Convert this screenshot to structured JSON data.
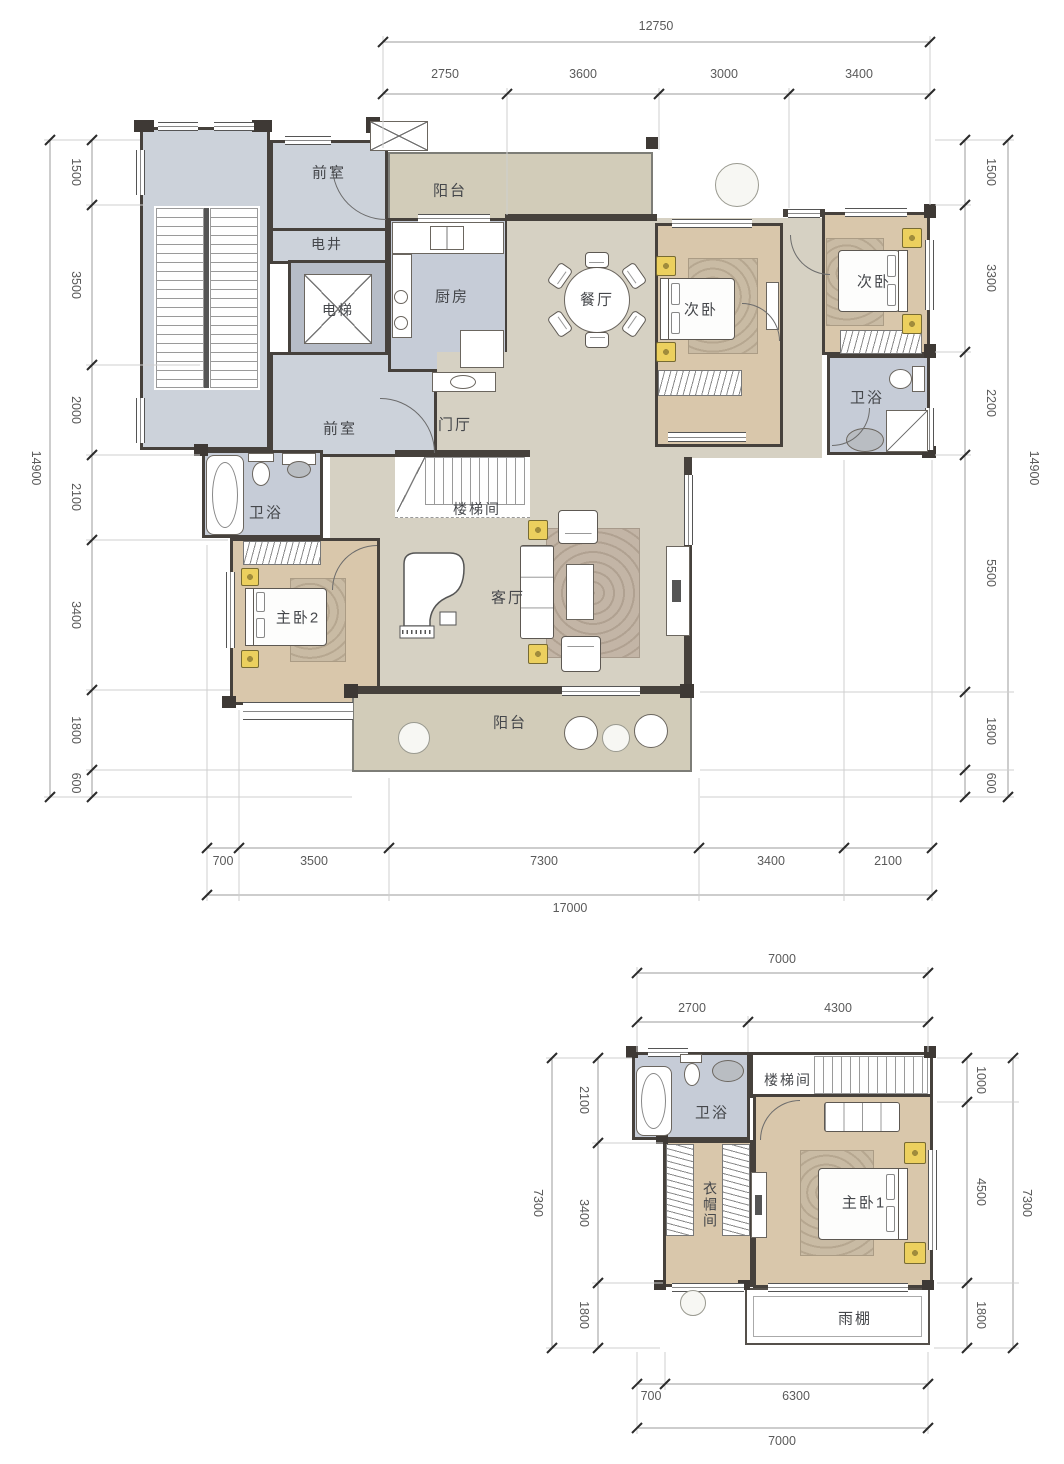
{
  "palette": {
    "wall": "#46413c",
    "room_gray": "#ccd2da",
    "room_bath": "#c6ccd7",
    "room_bedroom": "#d9c7ab",
    "room_open": "#d6d1c3",
    "balcony": "#d2ccb9",
    "nightstand_accent": "#ecd05e"
  },
  "plan1": {
    "rooms": {
      "front_top": "前室",
      "shaft": "电井",
      "elevator": "电梯",
      "front_bottom": "前室",
      "balcony_top": "阳台",
      "kitchen": "厨房",
      "dining": "餐厅",
      "bedroom_a": "次卧",
      "bedroom_b": "次卧",
      "bath_right": "卫浴",
      "foyer": "门厅",
      "bath_left": "卫浴",
      "stairwell": "楼梯间",
      "master2": "主卧2",
      "living": "客厅",
      "balcony_bottom": "阳台"
    },
    "dims": {
      "top_total": "12750",
      "top": [
        "2750",
        "3600",
        "3000",
        "3400"
      ],
      "left_total": "14900",
      "left": [
        "1500",
        "3500",
        "2000",
        "2100",
        "3400",
        "1800",
        "600"
      ],
      "right_total": "14900",
      "right": [
        "1500",
        "3300",
        "2200",
        "5500",
        "1800",
        "600"
      ],
      "bottom": [
        "700",
        "3500",
        "7300",
        "3400",
        "2100"
      ],
      "bottom_total": "17000"
    }
  },
  "plan2": {
    "rooms": {
      "bath": "卫浴",
      "stairwell": "楼梯间",
      "closet": "衣帽间",
      "master1": "主卧1",
      "canopy": "雨棚"
    },
    "dims": {
      "top_total": "7000",
      "top": [
        "2700",
        "4300"
      ],
      "left_total": "7300",
      "left": [
        "2100",
        "3400",
        "1800"
      ],
      "right_total": "7300",
      "right": [
        "1000",
        "4500",
        "1800"
      ],
      "bottom": [
        "700",
        "6300"
      ],
      "bottom_total": "7000"
    }
  }
}
